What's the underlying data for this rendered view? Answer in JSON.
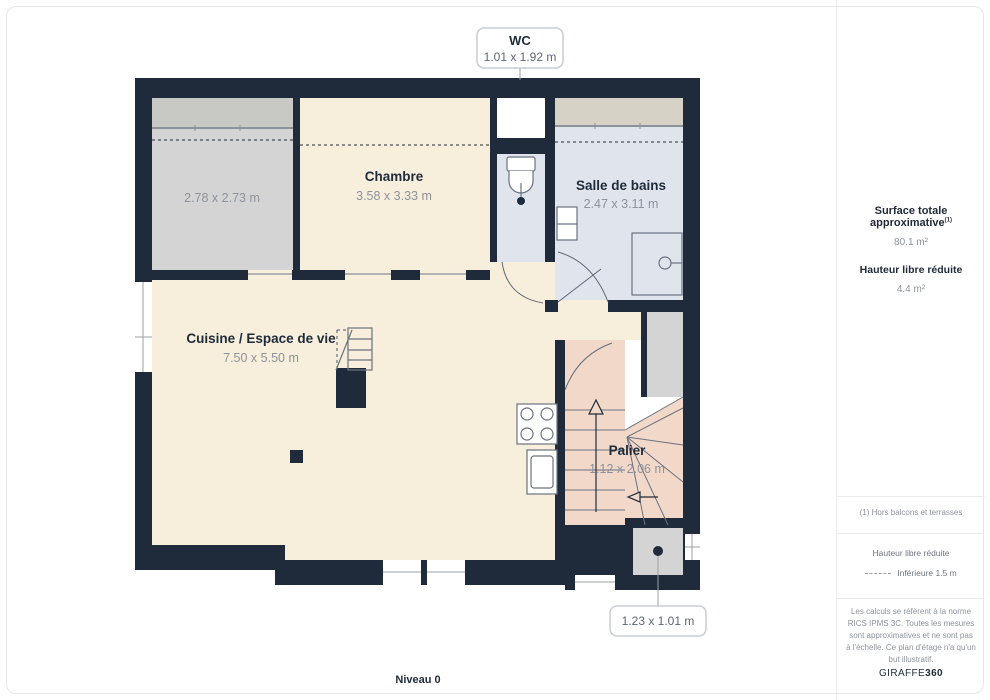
{
  "plan": {
    "level_label": "Niveau 0",
    "rooms": {
      "storage": {
        "dims": "2.78 x 2.73 m"
      },
      "chambre": {
        "name": "Chambre",
        "dims": "3.58 x 3.33 m"
      },
      "salle_de_bains": {
        "name": "Salle de bains",
        "dims": "2.47 x 3.11 m"
      },
      "cuisine": {
        "name": "Cuisine / Espace de vie",
        "dims": "7.50 x 5.50 m"
      },
      "palier": {
        "name": "Palier",
        "dims": "1.12 x 2.06 m"
      }
    },
    "callouts": {
      "wc": {
        "name": "WC",
        "dims": "1.01 x 1.92 m"
      },
      "small_room": {
        "dims": "1.23 x 1.01 m"
      }
    }
  },
  "sidebar": {
    "surface_title": "Surface totale approximative",
    "surface_sup": "(1)",
    "surface_value": "80.1 m²",
    "reduced_height_title": "Hauteur libre réduite",
    "reduced_height_value": "4.4 m²",
    "footnote": "(1) Hors balcons et terrasses",
    "legend_title": "Hauteur libre réduite",
    "legend_item": "Inférieure 1.5 m",
    "disclaimer": "Les calculs se réfèrent à la norme RICS IPMS 3C. Toutes les mesures sont approximatives et ne sont pas à l'échelle. Ce plan d'étage n'a qu'un but illustratif.",
    "brand_name": "GIRAFFE",
    "brand_suffix": "360"
  },
  "colors": {
    "wall": "#1f2b3a",
    "floor_living": "#f7eedb",
    "floor_storage": "#d4d4d4",
    "floor_wet": "#dfe4ed",
    "floor_stairs": "#f2d8c9",
    "text_dim": "#8d939c"
  }
}
